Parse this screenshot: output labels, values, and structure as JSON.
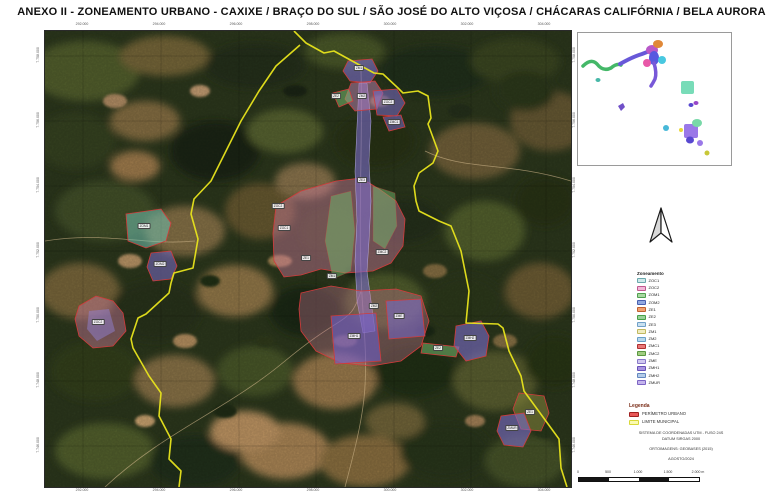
{
  "title": "ANEXO II - ZONEAMENTO URBANO - CAXIXE / BRAÇO DO SUL / SÃO JOSÉ DO ALTO VIÇOSA / CHÁCARAS CALIFÓRNIA / BELA AURORA",
  "map": {
    "top_coords": [
      "292.000",
      "294.000",
      "296.000",
      "298.000",
      "300.000",
      "302.000",
      "304.000"
    ],
    "bottom_coords": [
      "292.000",
      "294.000",
      "296.000",
      "298.000",
      "300.000",
      "302.000",
      "304.000"
    ],
    "left_coords": [
      "7.758.000",
      "7.756.000",
      "7.754.000",
      "7.752.000",
      "7.750.000",
      "7.748.000",
      "7.746.000"
    ],
    "right_coords": [
      "7.758.000",
      "7.756.000",
      "7.754.000",
      "7.752.000",
      "7.750.000",
      "7.748.000",
      "7.746.000"
    ],
    "zone_tags": [
      {
        "x": 315,
        "y": 38,
        "label": "ZM1"
      },
      {
        "x": 318,
        "y": 66,
        "label": "ZM2"
      },
      {
        "x": 292,
        "y": 66,
        "label": "ZE2"
      },
      {
        "x": 344,
        "y": 72,
        "label": "ZOC2"
      },
      {
        "x": 350,
        "y": 92,
        "label": "ZMC1"
      },
      {
        "x": 240,
        "y": 198,
        "label": "ZOC1"
      },
      {
        "x": 262,
        "y": 228,
        "label": "ZE1"
      },
      {
        "x": 288,
        "y": 246,
        "label": "ZM1"
      },
      {
        "x": 338,
        "y": 222,
        "label": "ZMC2"
      },
      {
        "x": 318,
        "y": 150,
        "label": "ZE3"
      },
      {
        "x": 330,
        "y": 276,
        "label": "ZM2"
      },
      {
        "x": 310,
        "y": 306,
        "label": "ZMH1"
      },
      {
        "x": 355,
        "y": 286,
        "label": "ZME"
      },
      {
        "x": 394,
        "y": 318,
        "label": "ZE2"
      },
      {
        "x": 234,
        "y": 176,
        "label": "ZOC2"
      },
      {
        "x": 100,
        "y": 196,
        "label": "ZOM1"
      },
      {
        "x": 116,
        "y": 234,
        "label": "ZOM2"
      },
      {
        "x": 54,
        "y": 292,
        "label": "ZOC2"
      },
      {
        "x": 426,
        "y": 308,
        "label": "ZMH2"
      },
      {
        "x": 486,
        "y": 382,
        "label": "ZE1"
      },
      {
        "x": 468,
        "y": 398,
        "label": "ZMUR"
      }
    ]
  },
  "legend_zoneamento": {
    "title": "Zoneamento",
    "items": [
      {
        "label": "ZOC1",
        "color": "#cfe9ea",
        "border": "#6aa8ac"
      },
      {
        "label": "ZOC2",
        "color": "#f2b8d8",
        "border": "#c05890"
      },
      {
        "label": "ZOM1",
        "color": "#a8d8a0",
        "border": "#50a050"
      },
      {
        "label": "ZOM2",
        "color": "#90a8e0",
        "border": "#4860b0"
      },
      {
        "label": "ZE1",
        "color": "#f0a070",
        "border": "#c06030"
      },
      {
        "label": "ZE2",
        "color": "#98d098",
        "border": "#48a048"
      },
      {
        "label": "ZE3",
        "color": "#c8e0f0",
        "border": "#70a0c8"
      },
      {
        "label": "ZM1",
        "color": "#f0ecc0",
        "border": "#c0b860"
      },
      {
        "label": "ZM2",
        "color": "#b8d8ec",
        "border": "#68a0c8"
      },
      {
        "label": "ZMC1",
        "color": "#e87878",
        "border": "#b03030"
      },
      {
        "label": "ZMC2",
        "color": "#a0cc80",
        "border": "#5a9840"
      },
      {
        "label": "ZME",
        "color": "#d0c8f0",
        "border": "#8878c8"
      },
      {
        "label": "ZMH1",
        "color": "#a894e0",
        "border": "#6850b8"
      },
      {
        "label": "ZMH2",
        "color": "#b4cce8",
        "border": "#6488c0"
      },
      {
        "label": "ZMUR",
        "color": "#c4b4ec",
        "border": "#7c64c4"
      }
    ]
  },
  "legend_linhas": {
    "title": "Legenda",
    "items": [
      {
        "label": "PERÍMETRO URBANO",
        "color": "#e85858",
        "border": "#a02020"
      },
      {
        "label": "LIMITE MUNICIPAL",
        "color": "#fafab0",
        "border": "#d8d838"
      }
    ]
  },
  "metadata": {
    "line1": "SISTEMA DE COORDENADAS UTM - FUSO 24S",
    "line2": "DATUM SIRGAS 2000",
    "line3": "ORTOIMAGENS: GEOBASES (2015)",
    "line4": "AGOSTO/2024"
  },
  "scalebar": {
    "labels": [
      "0",
      "500",
      "1.000",
      "1.500",
      "2.000 m"
    ]
  },
  "colors": {
    "urban_perimeter": "#d23b3b",
    "municipal_limit": "#e8e41c",
    "zone_purple": "#7b6ccb",
    "zone_pink": "#cd7a9b",
    "zone_green": "#74b86d",
    "zone_teal": "#6fbfae",
    "zone_olive": "#85853c"
  }
}
